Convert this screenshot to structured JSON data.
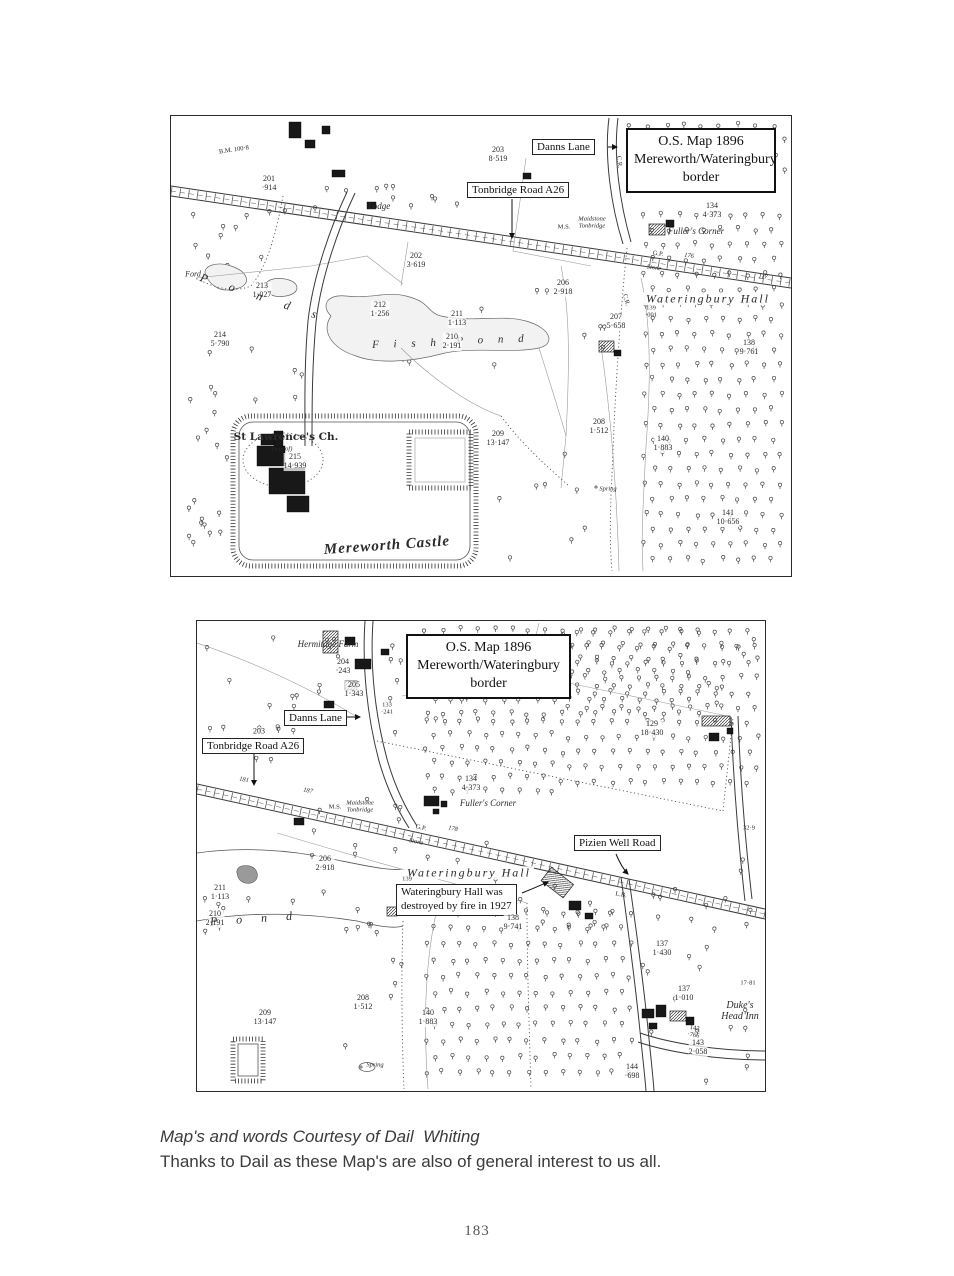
{
  "page_number": "183",
  "caption": {
    "line1": "Map's and words Courtesy of Dail  Whiting",
    "line2": "Thanks to Dail as these Map's are also of general interest to us all."
  },
  "map1": {
    "header": "O.S. Map 1896\nMereworth/Wateringbury\nborder",
    "boxes": {
      "danns_lane": "Danns Lane",
      "tonbridge_road": "Tonbridge Road A26"
    },
    "labels": {
      "p203": "203\n8·519",
      "p201": "201\n·914",
      "lodge": "Lodge",
      "p134": "134\n4·373",
      "fullers_corner": "Fuller's Corner",
      "p202": "202\n3·619",
      "p206": "206\n2·918",
      "wateringbury_hall": "Wateringbury Hall",
      "p212": "212\n1·256",
      "p211": "211\n1·113",
      "p207": "207\n5·658",
      "p139": "139\n·001",
      "p138": "138\n9·761",
      "p214": "214\n5·790",
      "p213": "213\n1·027",
      "ford": "Ford",
      "ponds": "P o n d s",
      "fish": "F i s h",
      "pond_word": "P o n d",
      "p210": "210\n2·191",
      "st_lawrence": "St Lawrence's Ch.",
      "site_of": "(Site of)",
      "p215": "215\n14·939",
      "p209": "209\n13·147",
      "p208": "208\n1·512",
      "p140": "140\n1·883",
      "spring": "Spring",
      "mereworth_castle": "Mereworth Castle",
      "p141": "141\n10·656",
      "bm": "B.M. 100·8",
      "gp": "G.P.",
      "stone": "Stone",
      "ms": "M.S.",
      "fingerpost": "Maidstone\nTonbridge",
      "rn176": "176",
      "rn117": "117",
      "cr1": "C.R.",
      "cr2": "C.R."
    }
  },
  "map2": {
    "header": "O.S. Map 1896\nMereworth/Wateringbury\nborder",
    "boxes": {
      "danns_lane": "Danns Lane",
      "tonbridge_road": "Tonbridge Road A26",
      "pizien_well": "Pizien Well Road",
      "fire_note": "Wateringbury Hall was\ndestroyed by fire in 1927"
    },
    "labels": {
      "hermitage_farm": "Hermitage Farm",
      "p204": "204\n·243",
      "p205": "205\n1·343",
      "p133": "133\n·241",
      "p203": "203",
      "rn181": "181",
      "rn187": "187",
      "ms": "M.S.",
      "fingerpost": "Maidstone\nTonbridge",
      "p134": "134\n4·373",
      "fullers_corner": "Fuller's Corner",
      "gp": "G.P.",
      "stone": "Stone",
      "rn178": "178",
      "p129": "129\n18·430",
      "bm329": "32·9",
      "wateringbury_hall": "Wateringbury Hall",
      "p139": "139",
      "p138": "138\n9·741",
      "lb": "L.B.",
      "p206": "206\n2·918",
      "p211": "211\n1·113",
      "p210": "210\n2·191",
      "pond_word": "P o n d",
      "p209": "209\n13·147",
      "p208": "208\n1·512",
      "p140": "140\n1·883",
      "spring": "Spring",
      "p137a": "137\n1·430",
      "p137b": "137\n1·010",
      "n1781": "17·81",
      "dukes_head": "Duke's\nHead Inn",
      "p143": "143\n2·058",
      "p144": "144\n·698",
      "rn142": "142\n·766"
    }
  }
}
